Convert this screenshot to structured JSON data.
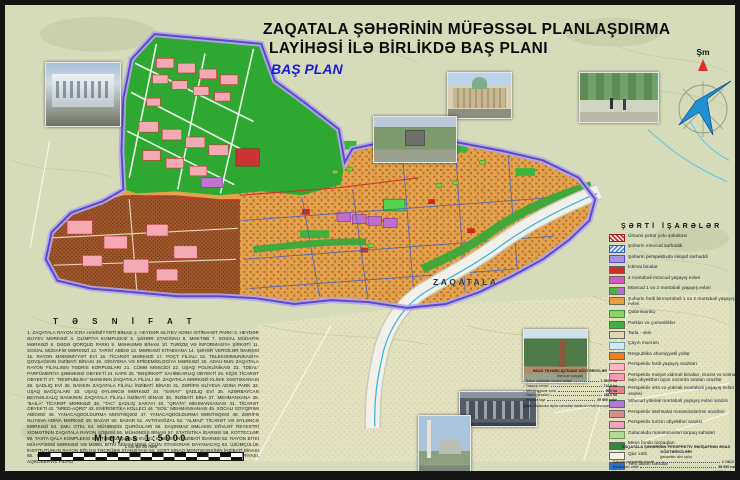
{
  "title": {
    "line1": "ZAQATALA  ŞƏHƏRİNİN   MÜFƏSSƏL PLANLAŞDIRMA",
    "line2": "LAYİHƏSİ İLƏ BİRLİKDƏ BAŞ PLANI",
    "subtitle": "BAŞ PLAN"
  },
  "compass": {
    "north_label": "Şm"
  },
  "map": {
    "city_label": "ZAQATALA"
  },
  "legend": {
    "title": "ŞƏRTİ İŞARƏLƏR",
    "items": [
      {
        "chip": "road",
        "label": "Ümumi şəhər yolu şəbəkəsi"
      },
      {
        "chip": "boundary-exist",
        "label": "Şəhərin mövcud sərhəddi"
      },
      {
        "chip": "boundary-persp",
        "label": "Şəhərin perspektivdə inkişaf sərhəddi"
      },
      {
        "chip": "public",
        "label": "İctimai binalar"
      },
      {
        "chip": "res4",
        "label": "4 mərtəbəli mövcud yaşayış evləri"
      },
      {
        "chip": "res12",
        "label": "Mövcud 1 və 2 mərtəbəli yaşayış evləri"
      },
      {
        "chip": "indiv",
        "label": "Şəhərin fərdi birmərtəbəli 1 və 2 mərtəbəli yaşayış evləri"
      },
      {
        "chip": "cemetery",
        "label": "Qəbiristanlıq"
      },
      {
        "chip": "park",
        "label": "Parklar və çəmənliklər"
      },
      {
        "chip": "field",
        "label": "Tarla - əkin"
      },
      {
        "chip": "river",
        "label": "Çayın məcrası"
      },
      {
        "chip": "important",
        "label": "Respublika əhəmiyyətli yollar"
      },
      {
        "chip": "p-indiv",
        "label": "Perspektiv fərdi yaşayış əraziləri"
      },
      {
        "chip": "p-service",
        "label": "Perspektiv məişət xidməti binaları, ticarət və ictimai iaşə obyektləri üçün nəzərdə tutulan ərazilər"
      },
      {
        "chip": "p-mid",
        "label": "Perspektiv orta və yüksək mərtəbəli yaşayış evləri ərazisi"
      },
      {
        "chip": "p-high",
        "label": "Mövcud yüksək mərtəbəli yaşayış evləri ərazisi"
      },
      {
        "chip": "p-industry",
        "label": "Perspektiv istehsalat müəssisələrinin əraziləri"
      },
      {
        "chip": "p-tourism",
        "label": "Perspektiv turizm obyektləri ərazisi"
      },
      {
        "chip": "future-land",
        "label": "Gələcəkdə mənimsənilən torpaq sahələri"
      },
      {
        "chip": "forest",
        "label": "Meşə fondu torpaqları"
      },
      {
        "chip": "gas",
        "label": "Qaz xətti"
      },
      {
        "chip": "dam",
        "label": "Yeni tikilən bəndlər"
      },
      {
        "chip": "sewer",
        "label": "Kanalizasiya xətti"
      },
      {
        "chip": "water",
        "label": "Su xətti"
      },
      {
        "chip": "electric",
        "label": "Elektrik xətti"
      }
    ]
  },
  "tesnifat": {
    "heading": "T Ə S N İ F A T",
    "text": "1. ZAQATALA RAYON İCRA HAKİMİYYƏTİ BİNASI 2. HEYDƏR ƏLİYEV ADINA İSTİRAHƏT PARKI 3. HEYDƏR ƏLİYEV MƏRKƏZİ 4. OLİMPİYA KOMPLEKSİ 5. ŞƏHƏR STADİONU 6. MƏKTƏB 7. SOSİAL MÜDAFİƏ MƏRKƏZİ 8. DƏDƏ QORQUD PARKI 9. MƏHKƏMƏ BİNASI 10. TURİZM VƏ İNFORMASİYA ŞİRKƏTİ 11. SOSİAL MÜDAFİƏ MƏRKƏZİ 12. TARİXİ ABİDƏ 13. MƏRKƏZİ KİTABXANA 14. ŞƏHƏR VERGİLƏR İDARƏSİ 15. RAYON MƏDƏNİYYƏT EVİ 16. TİCARƏT MƏRKƏZİ 17. POÇT FİLİALI 18. TELEKOMMUNİKASİYA QOVŞAĞININ İNZİBATİ BİNASI 19. GİGİYENA VƏ EPİDEMİOLOGİYA MƏRKƏZİ 20. ADAU-NUN ZAQATALA RAYON FİLİALININ TƏDRİS KORPUSLARI 21. CÜMƏ MƏSCİDİ 22. UŞAQ POLİKLİNİKASI 23. “İDEAL” PARFÜMERİYA ŞƏBƏKƏSİ OBYEKTİ 24. KAFE 25. “BƏŞİRKƏT” SAHİBKARLIQ OBYEKTİ 26. KİÇİK TİCARƏT OBYEKTİ 27. “RESPUBLİKA” BANKININ ZAQATALA FİLİALI 28. ZAQATALA MƏRKƏZİ KLİNİK XƏSTƏXANASI 29. ŞADLIQ EVİ 30. BANKIN ZAQATALA FİLİALI İNZİBATİ BİNASI 31. ZƏRİFƏ ƏLİYEVA ADINA PARK 32. UŞAQ BAĞÇALARI 33. UŞAQ ƏYLƏNCƏ MƏRKƏZİ 34. “SARAY” ŞADLIQ EVİ 35. AZƏRBAYCAN BEYNƏLXALQ BANKININ ZAQATALA FİLİALI İNZİBATİ BİNASI 36. İNZİBATİ BİNA 37. MEHMANXANA 38. “BAİLA” TİCARƏT MƏRKƏZİ 39. “TAC” ŞADLIQ SARAYI 40. “QRATA” MEHMANXANASI 41. TİCARƏT OBYEKTİ 42. “NRED-AQRO” 43. ENERGETİKA KOLLECİ 44. “SOİL” MEHMANXANASI 45. XOCALI SOYQIRIMI ABİDƏSİ 46. YANACAQDOLDURMA MƏNTƏQƏSİ 47. YANACAQDOLDURMA MƏNTƏQƏSİ 48. ZƏRİFƏ ƏLİYEVA ADINA MƏRKƏZ 49. BAZAR 50. BAZAR 51. AVTOVAĞZAL 52. “ALMAZ” TİCARƏT VƏ ƏYLƏNCƏ MƏRKƏZİ 53. ŞMU OTEL 54. MÜHƏNDİS QURĞULARI 55. DAŞINMAZ ƏMLAKIN DÖVLƏT REYESTRİ XİDMƏTİNİN ZAQATALA RAYON ŞÖBƏSİ 56. MÜHƏNDİS BİNASI 57. STATİSTİKA İDARƏSİ 58. KOTTECLƏR 59. TAXTA QALA KOMPLEKSİ 60. “TƏBRİZ” ŞADLIQ EVİ 61. KABİNETİN İNZİBATİ İDARƏSİ 62. RAYON BİTKİ MÜHAFİZƏSİ MƏRKƏZİ VƏ MOBİL BİTKİ MÜHAFİZƏSİ ÜÇÜN STASİONAR DAYANACAQ 63. ÜZÜMÇÜLÜK İNSTİTUTUNUN RAYON BÖLGƏ TƏCRÜBƏ STANSİYASI 64. SORT SINAQ MƏNTƏQƏSİNİN İNZİBATİ BİNASI 65. RAYON MEYVƏÇİLİK DÖVLƏT SORT SINAQ MÜFƏTTİŞLİYİ VƏ AQROKİMYA LABORATORİYASI, AQROSERVİS FİLİALI"
  },
  "scale": {
    "title": "Miqyas 1:5000",
    "subtitle": "1 sm-də 50 metr",
    "ticks": [
      "500",
      "0",
      "500",
      "1000",
      "1500"
    ]
  },
  "stats_mid": {
    "heading": "ƏSAS TEXNİKİ-İQTİSADİ GÖSTƏRİCİLƏR",
    "subheading": "(mövcud vəziyyət)",
    "rows": [
      {
        "label": "– Şəhər ərazisinin ümumi sahəsi",
        "value": "1 360,0 ha"
      },
      {
        "label": "– Yaşayış zonası",
        "value": "742,0 ha"
      },
      {
        "label": "– İctimai-işgüzar zona",
        "value": "96,0 ha"
      },
      {
        "label": "– Yaşıllıq əraziləri",
        "value": "188,0 ha"
      },
      {
        "label": "– Əhalinin sayı",
        "value": "29 800 nəfər"
      }
    ],
    "note_label": "Qeyd:",
    "note": "Göstəricilər layihə sərhədləri daxilində hesablanmışdır."
  },
  "stats_right": {
    "heading": "ZAQATALA ŞƏHƏRİNİN PERSPEKTİV İNKİŞAFININ ƏSAS GÖSTƏRİCİLƏRİ",
    "subheading": "(perspektiv dövr üçün)",
    "rows": [
      {
        "label": "Şəhərin perspektiv ərazisi",
        "value": "1 742,0 ha"
      },
      {
        "label": "Perspektiv əhali",
        "value": "38 000 nəfər"
      },
      {
        "label": "Yaşayış fondu",
        "value": "1 026,0 min m²"
      },
      {
        "label": "Fərdi yaşayış evləri",
        "value": "7 430 ədəd"
      },
      {
        "label": "Orta mərtəbəlilik",
        "value": "2,4 mərtəbə"
      },
      {
        "label": "Yaşıllıqların sahəsi",
        "value": "264,0 ha"
      },
      {
        "label": "Adambaşına yaşıllıq",
        "value": "9,6 m²"
      }
    ]
  },
  "colors": {
    "topo_background": "#d6dcba",
    "urban_orange": "#e3a34b",
    "green_district": "#2fa832",
    "orchard_brown": "#a05a2c",
    "boundary_purple": "#5b49c8",
    "boundary_halo": "#b2a6ea",
    "river_grey": "#f1f1e8",
    "river_channel_blue": "#3fb2e0",
    "residential_pink": "#f2aab4",
    "magenta_blocks": "#bd6fd0",
    "title_blue": "#1b1bd0",
    "north_arrow_red": "#e03030",
    "wind_rose_blue": "#2090d2"
  }
}
